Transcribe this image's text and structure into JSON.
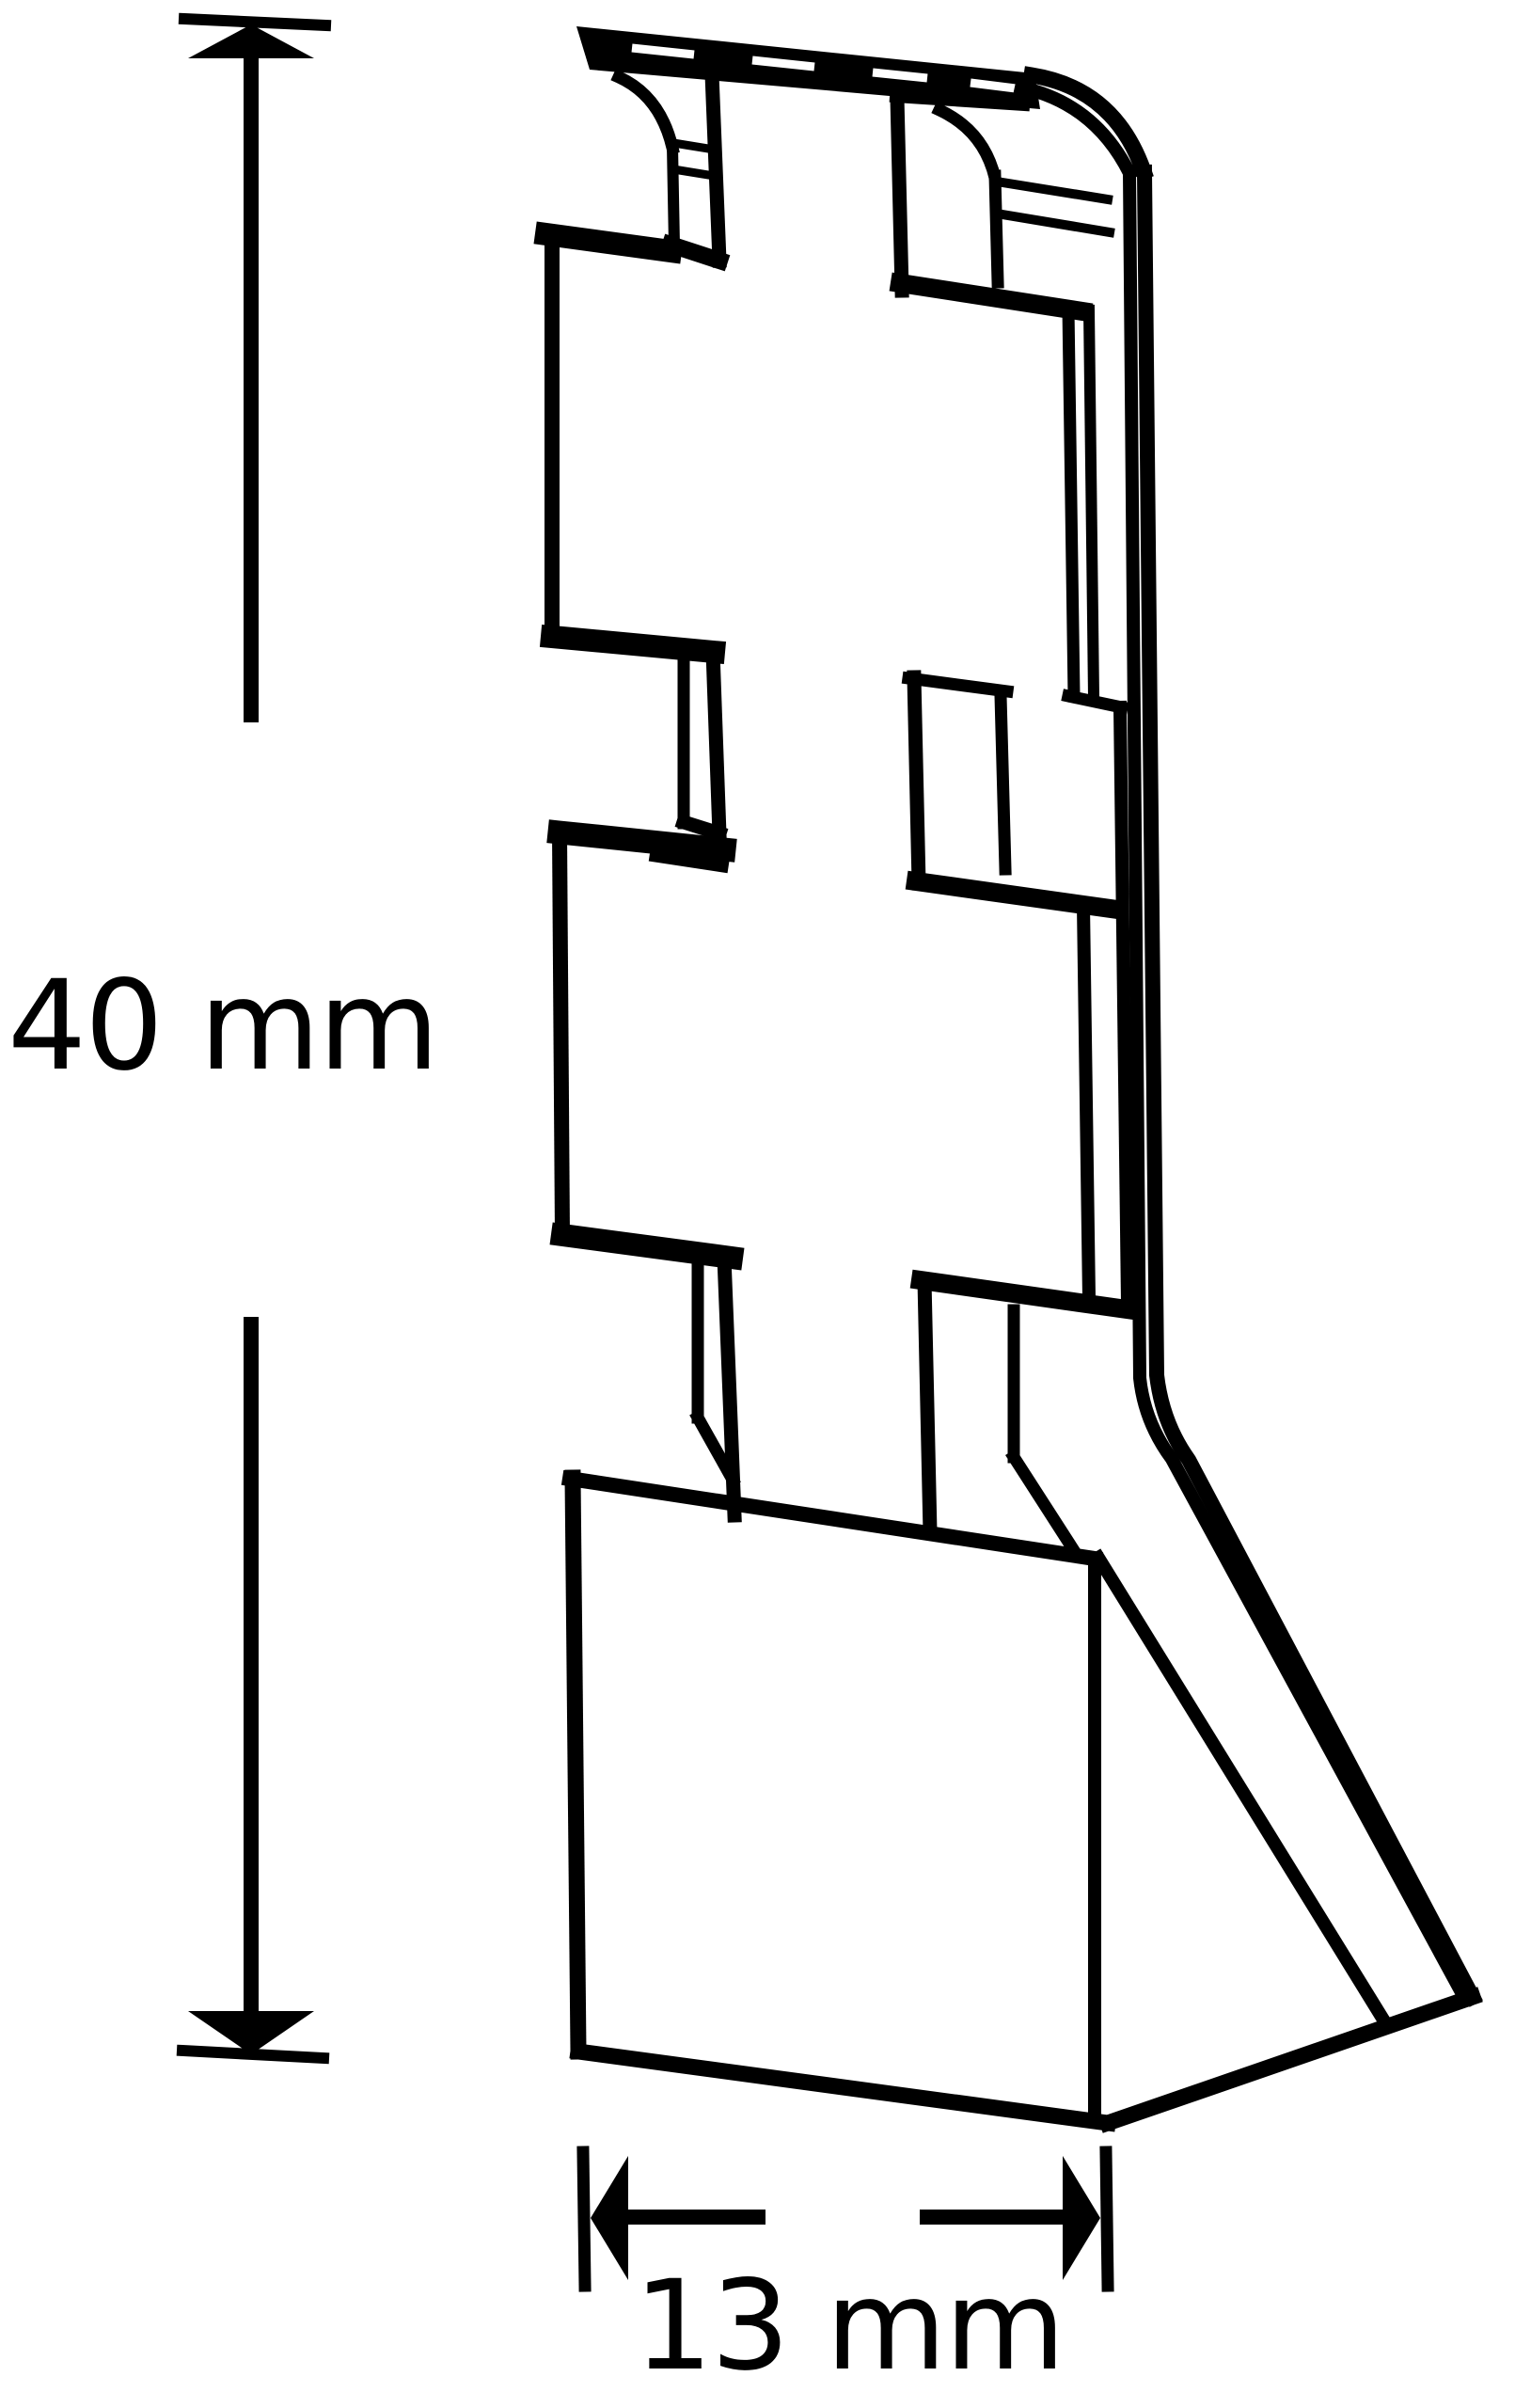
{
  "figure": {
    "kind": "technical line drawing",
    "subject": "profile end-cap piece shown in isometric view",
    "background_color": "#ffffff",
    "line_color": "#000000"
  },
  "dimensions": {
    "height": {
      "label": "40 mm",
      "value": 40,
      "unit": "mm",
      "orientation": "vertical"
    },
    "depth": {
      "label": "13 mm",
      "value": 13,
      "unit": "mm",
      "orientation": "horizontal"
    }
  }
}
